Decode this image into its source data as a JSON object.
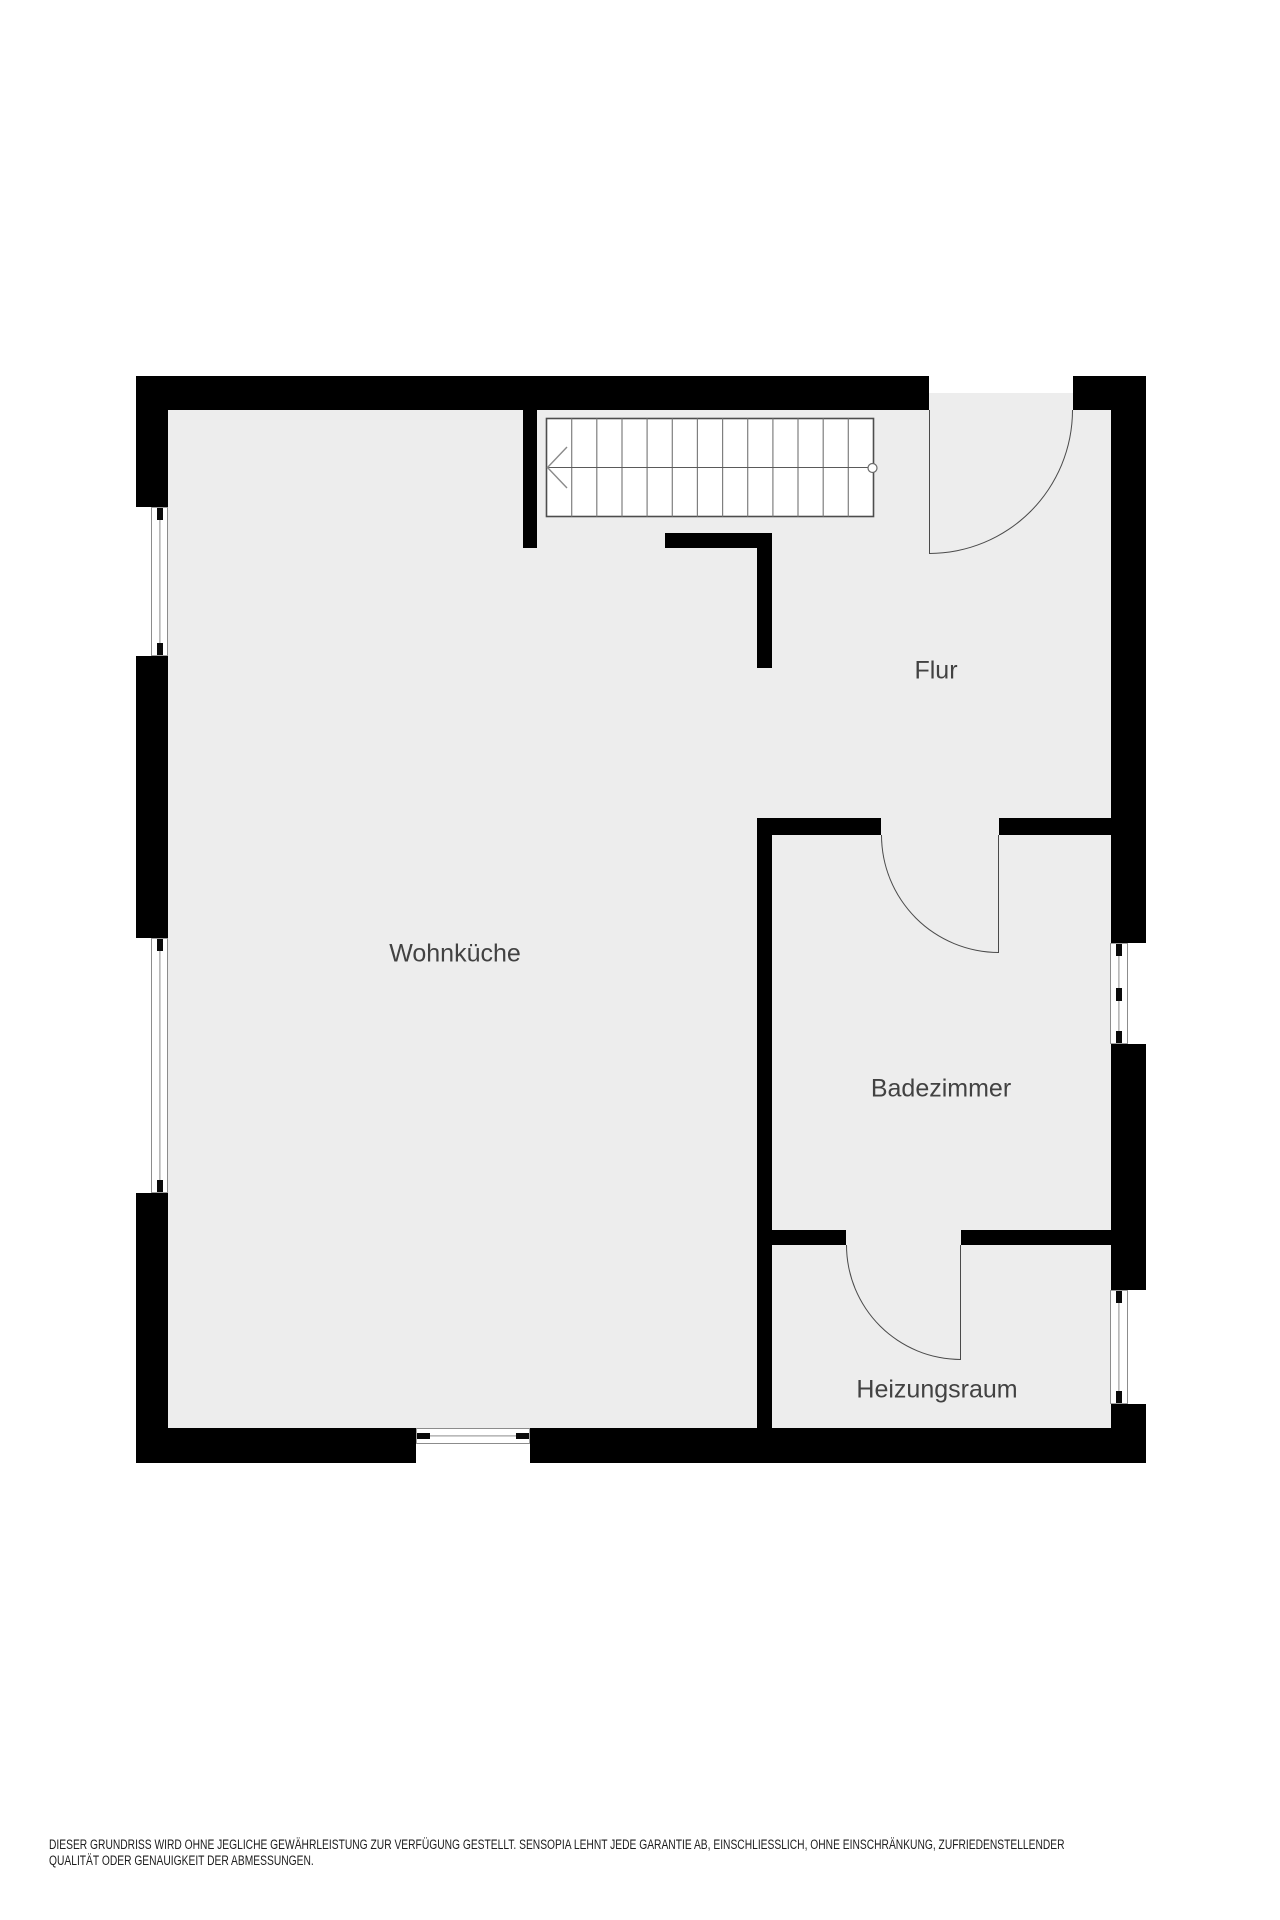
{
  "plan": {
    "colors": {
      "floor": "#ededed",
      "wall": "#000000",
      "label_text": "#424242",
      "line": "#4a4a4a"
    },
    "rooms": [
      {
        "name": "Wohnküche"
      },
      {
        "name": "Flur"
      },
      {
        "name": "Badezimmer"
      },
      {
        "name": "Heizungsraum"
      }
    ]
  },
  "disclaimer": {
    "line1": "DIESER GRUNDRISS WIRD OHNE JEGLICHE GEWÄHRLEISTUNG ZUR VERFÜGUNG GESTELLT. SENSOPIA LEHNT JEDE GARANTIE AB, EINSCHLIESSLICH, OHNE EINSCHRÄNKUNG, ZUFRIEDENSTELLENDER",
    "line2": "QUALITÄT ODER GENAUIGKEIT DER ABMESSUNGEN."
  }
}
